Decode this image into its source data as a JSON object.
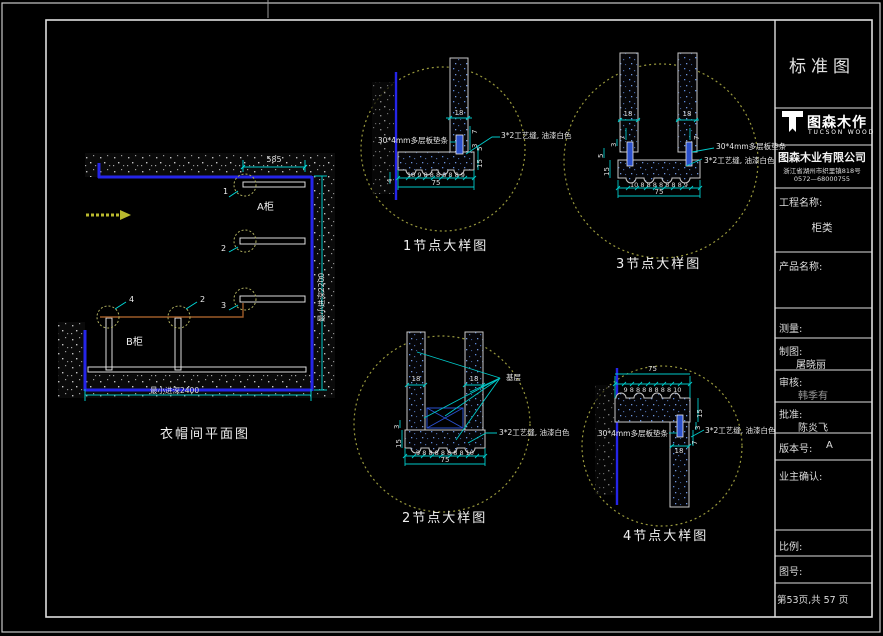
{
  "colors": {
    "background": "#000000",
    "frame": "#d4d4d4",
    "dimension_cyan": "#00d8d8",
    "wall_blue": "#2525e8",
    "detail_circle_olive": "#98983c",
    "annotation_text": "#e8e8e8",
    "section_brown": "#9c5a28",
    "arrow_yellow": "#b9b92e",
    "spacer_blue": "#2a50cc"
  },
  "titleblock": {
    "title": "标准图",
    "logo_cn": "图森木作",
    "logo_en": "TUCSON WOOD",
    "company": "图森木业有限公司",
    "address": "浙江省湖州市织里镇818号",
    "phone": "0572—68000755",
    "project_label": "工程名称:",
    "project_value": "柜类",
    "product_label": "产品名称:",
    "measure_label": "测量:",
    "draft_label": "制图:",
    "draft_value": "屠晓丽",
    "review_label": "审核:",
    "review_value": "韩季有",
    "approve_label": "批准:",
    "approve_value": "陈炎飞",
    "version_label": "版本号:",
    "version_value": "A",
    "owner_label": "业主确认:",
    "scale_label": "比例:",
    "dwgno_label": "图号:",
    "page_info": "第53页,共 57 页"
  },
  "plan": {
    "caption": "衣帽间平面图",
    "cabinet_a": "A柜",
    "cabinet_b": "B柜",
    "dim_top": "585",
    "dim_right": "最小进深2200",
    "dim_bottom": "最小进深2400",
    "callout_1": "1",
    "callout_2": "2",
    "callout_3": "3",
    "callout_4": "4",
    "callout_5": "2"
  },
  "details": {
    "d1": {
      "caption": "1节点大样图",
      "dim_panel": "18",
      "dim_s1": "7",
      "dim_s2": "3",
      "dim_s3": "5",
      "dim_s4": "15",
      "dim_left": "4",
      "chain": [
        "10",
        "9",
        "8",
        "8",
        "8",
        "8",
        "8",
        "8",
        "9"
      ],
      "total": "75",
      "label_spacer": "30*4mm多层板垫条",
      "label_seam": "3*2工艺缝, 油漆白色"
    },
    "d2": {
      "caption": "2节点大样图",
      "dim_panel_l": "18",
      "dim_panel_r": "18",
      "dim_s1": "3",
      "dim_s2": "15",
      "chain": [
        "9",
        "8",
        "8",
        "8",
        "8",
        "8",
        "8",
        "8",
        "10"
      ],
      "total": "75",
      "label_base": "基层",
      "label_seam": "3*2工艺缝, 油漆白色"
    },
    "d3": {
      "caption": "3节点大样图",
      "dim_panel_l": "18",
      "dim_panel_r": "18",
      "dim_s1": "7",
      "dim_s2": "7",
      "dim_s3": "3",
      "dim_s4": "5",
      "dim_s5": "15",
      "chain": [
        "10",
        "8",
        "8",
        "8",
        "8",
        "8",
        "8",
        "8",
        "9"
      ],
      "total": "75",
      "label_spacer": "30*4mm多层板垫条",
      "label_seam": "3*2工艺缝, 油漆白色"
    },
    "d4": {
      "caption": "4节点大样图",
      "dim_panel": "18",
      "dim_s1": "15",
      "dim_s2": "3",
      "dim_s3": "7",
      "chain": [
        "9",
        "8",
        "8",
        "8",
        "8",
        "8",
        "8",
        "8",
        "10"
      ],
      "total": "75",
      "label_spacer": "30*4mm多层板垫条",
      "label_seam": "3*2工艺缝, 油漆白色"
    }
  }
}
